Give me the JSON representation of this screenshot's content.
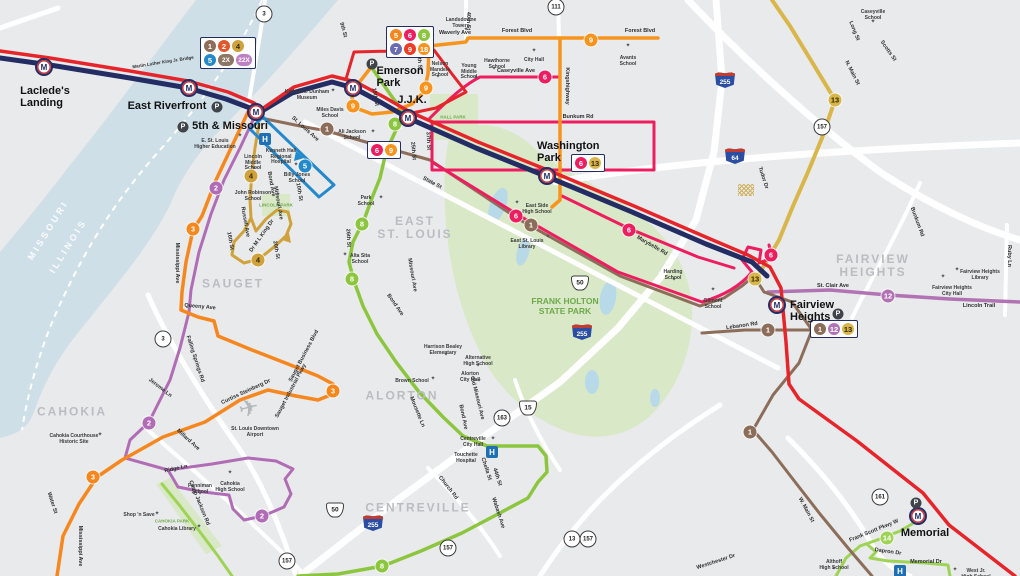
{
  "map": {
    "width": 1020,
    "height": 576,
    "bg": "#e9eaec"
  },
  "colors": {
    "metrolink_navy": "#232d63",
    "metrolink_red": "#e6252b",
    "river": "#cfdfe8",
    "road": "#ffffff",
    "park": "#d9e8c6",
    "pond": "#b8d9e8",
    "area_label": "#b9bdc2",
    "park_label": "#6ea94c",
    "routes": {
      "1": "#8c6d5a",
      "2": "#b06db5",
      "3": "#f6871f",
      "4": "#cfa23c",
      "5": "#2389cb",
      "6": "#ee1d60",
      "7": "#6b6cb0",
      "8": "#8cc63f",
      "9": "#f7941d",
      "12": "#b273b5",
      "13": "#d9b64a",
      "14": "#9fd356",
      "18": "#f6921e",
      "2X": "#8d7663",
      "22X": "#c07fc4"
    }
  },
  "areas": [
    {
      "t": "SAUGET",
      "x": 233,
      "y": 284
    },
    {
      "t": "CAHOKIA",
      "x": 72,
      "y": 412
    },
    {
      "t": "EAST\nST. LOUIS",
      "x": 415,
      "y": 228
    },
    {
      "t": "ALORTON",
      "x": 402,
      "y": 396
    },
    {
      "t": "CENTREVILLE",
      "x": 418,
      "y": 508
    },
    {
      "t": "FAIRVIEW\nHEIGHTS",
      "x": 873,
      "y": 266
    }
  ],
  "river_labels": [
    {
      "t": "MISSOURI",
      "x": 48,
      "y": 230,
      "r": -58
    },
    {
      "t": "ILLINOIS",
      "x": 68,
      "y": 246,
      "r": -58
    }
  ],
  "park_labels": [
    {
      "t": "FRANK HOLTON\nSTATE PARK",
      "x": 565,
      "y": 307,
      "s": 8.5
    },
    {
      "t": "HALL PARK",
      "x": 453,
      "y": 117,
      "s": 4.5
    },
    {
      "t": "LINCOLN PARK",
      "x": 276,
      "y": 205,
      "s": 4.5
    },
    {
      "t": "CAHOKIA PARK",
      "x": 172,
      "y": 521,
      "s": 4.5
    }
  ],
  "stations": [
    {
      "name": "lacledes-landing",
      "t": "Laclede's\nLanding",
      "mx": 44,
      "my": 67,
      "lx": 45,
      "ly": 86,
      "align": "c"
    },
    {
      "name": "east-riverfront",
      "t": "East Riverfront",
      "mx": 189,
      "my": 88,
      "lx": 167,
      "ly": 101,
      "align": "c"
    },
    {
      "name": "5th-missouri",
      "t": "5th & Missouri",
      "mx": 256,
      "my": 112,
      "lx": 230,
      "ly": 121,
      "align": "c"
    },
    {
      "name": "emerson-park",
      "t": "Emerson\nPark",
      "mx": 353,
      "my": 88,
      "lx": 400,
      "ly": 66,
      "align": "c"
    },
    {
      "name": "jjk",
      "t": "J.J.K.",
      "mx": 408,
      "my": 118,
      "lx": 412,
      "ly": 95,
      "align": "c"
    },
    {
      "name": "washington-park",
      "t": "Washington\nPark",
      "mx": 547,
      "my": 176,
      "lx": 537,
      "ly": 141,
      "align": "l"
    },
    {
      "name": "fairview-heights",
      "t": "Fairview\nHeights",
      "mx": 777,
      "my": 305,
      "lx": 790,
      "ly": 300,
      "align": "l"
    },
    {
      "name": "memorial",
      "t": "Memorial",
      "mx": 918,
      "my": 516,
      "lx": 925,
      "ly": 528,
      "align": "c"
    }
  ],
  "p_markers": [
    [
      217,
      107
    ],
    [
      183,
      127
    ],
    [
      372,
      64
    ],
    [
      838,
      314
    ],
    [
      916,
      503
    ]
  ],
  "hospitals": [
    [
      265,
      139
    ],
    [
      492,
      452
    ],
    [
      900,
      571
    ]
  ],
  "badge_boxes": [
    {
      "x": 228,
      "y": 53,
      "rows": [
        [
          {
            "n": "1",
            "c": "#8c6d5a"
          },
          {
            "n": "2",
            "c": "#e2572b"
          },
          {
            "n": "4",
            "c": "#cfa23c",
            "tc": "#332800"
          }
        ],
        [
          {
            "n": "5",
            "c": "#2389cb"
          },
          {
            "n": "2X",
            "c": "#8d7663"
          },
          {
            "n": "22X",
            "c": "#c07fc4"
          }
        ]
      ]
    },
    {
      "x": 410,
      "y": 42,
      "rows": [
        [
          {
            "n": "5",
            "c": "#f6871f"
          },
          {
            "n": "6",
            "c": "#ee1d60"
          },
          {
            "n": "8",
            "c": "#8cc63f"
          }
        ],
        [
          {
            "n": "7",
            "c": "#6b6cb0"
          },
          {
            "n": "9",
            "c": "#ee3b24"
          },
          {
            "n": "18",
            "c": "#f6921e"
          }
        ]
      ]
    },
    {
      "x": 384,
      "y": 150,
      "rows": [
        [
          {
            "n": "6",
            "c": "#ee1d60"
          },
          {
            "n": "9",
            "c": "#f7941d"
          }
        ]
      ]
    },
    {
      "x": 588,
      "y": 163,
      "rows": [
        [
          {
            "n": "6",
            "c": "#ee1d60"
          },
          {
            "n": "13",
            "c": "#d9b64a",
            "tc": "#332800"
          }
        ]
      ]
    },
    {
      "x": 834,
      "y": 329,
      "rows": [
        [
          {
            "n": "1",
            "c": "#8c6d5a"
          },
          {
            "n": "12",
            "c": "#b273b5"
          },
          {
            "n": "13",
            "c": "#d9b64a",
            "tc": "#332800"
          }
        ]
      ]
    }
  ],
  "badges": [
    {
      "n": "1",
      "x": 327,
      "y": 129
    },
    {
      "n": "1",
      "x": 531,
      "y": 225
    },
    {
      "n": "1",
      "x": 768,
      "y": 330
    },
    {
      "n": "1",
      "x": 750,
      "y": 432
    },
    {
      "n": "2",
      "x": 216,
      "y": 188
    },
    {
      "n": "2",
      "x": 149,
      "y": 423
    },
    {
      "n": "2",
      "x": 262,
      "y": 516
    },
    {
      "n": "3",
      "x": 193,
      "y": 229
    },
    {
      "n": "3",
      "x": 93,
      "y": 477
    },
    {
      "n": "3",
      "x": 333,
      "y": 391
    },
    {
      "n": "4",
      "x": 251,
      "y": 176,
      "tc": "#332800"
    },
    {
      "n": "4",
      "x": 258,
      "y": 260,
      "tc": "#332800"
    },
    {
      "n": "5",
      "x": 305,
      "y": 166
    },
    {
      "n": "6",
      "x": 545,
      "y": 77
    },
    {
      "n": "6",
      "x": 516,
      "y": 216
    },
    {
      "n": "6",
      "x": 629,
      "y": 230
    },
    {
      "n": "6",
      "x": 771,
      "y": 255
    },
    {
      "n": "8",
      "x": 395,
      "y": 124
    },
    {
      "n": "8",
      "x": 362,
      "y": 224
    },
    {
      "n": "8",
      "x": 352,
      "y": 279
    },
    {
      "n": "8",
      "x": 382,
      "y": 566
    },
    {
      "n": "9",
      "x": 353,
      "y": 106
    },
    {
      "n": "9",
      "x": 426,
      "y": 88
    },
    {
      "n": "9",
      "x": 591,
      "y": 40
    },
    {
      "n": "12",
      "x": 888,
      "y": 296
    },
    {
      "n": "13",
      "x": 835,
      "y": 100,
      "tc": "#332800"
    },
    {
      "n": "13",
      "x": 755,
      "y": 279,
      "tc": "#332800"
    },
    {
      "n": "14",
      "x": 887,
      "y": 538
    }
  ],
  "shields": [
    {
      "k": "c",
      "t": "3",
      "x": 264,
      "y": 14
    },
    {
      "k": "c",
      "t": "111",
      "x": 556,
      "y": 7
    },
    {
      "k": "c",
      "t": "3",
      "x": 163,
      "y": 339
    },
    {
      "k": "c",
      "t": "157",
      "x": 822,
      "y": 127
    },
    {
      "k": "c",
      "t": "157",
      "x": 448,
      "y": 548
    },
    {
      "k": "c",
      "t": "13",
      "x": 572,
      "y": 539
    },
    {
      "k": "c",
      "t": "157",
      "x": 588,
      "y": 539
    },
    {
      "k": "c",
      "t": "157",
      "x": 287,
      "y": 561
    },
    {
      "k": "c",
      "t": "163",
      "x": 502,
      "y": 418
    },
    {
      "k": "c",
      "t": "161",
      "x": 880,
      "y": 497
    },
    {
      "k": "u",
      "t": "50",
      "x": 580,
      "y": 283
    },
    {
      "k": "u",
      "t": "50",
      "x": 335,
      "y": 510
    },
    {
      "k": "u",
      "t": "15",
      "x": 528,
      "y": 408
    },
    {
      "k": "i",
      "t": "255",
      "x": 725,
      "y": 80
    },
    {
      "k": "i",
      "t": "64",
      "x": 735,
      "y": 156
    },
    {
      "k": "i",
      "t": "255",
      "x": 582,
      "y": 332
    },
    {
      "k": "i",
      "t": "255",
      "x": 373,
      "y": 523
    }
  ],
  "streets": [
    {
      "t": "Martin Luther King Jr. Bridge",
      "x": 163,
      "y": 62,
      "r": -9,
      "s": 4.5
    },
    {
      "t": "Waverly Ave",
      "x": 455,
      "y": 33,
      "r": 0
    },
    {
      "t": "Forest Blvd",
      "x": 517,
      "y": 31,
      "r": 0
    },
    {
      "t": "Forest Blvd",
      "x": 640,
      "y": 31,
      "r": 0
    },
    {
      "t": "40th St",
      "x": 468,
      "y": 21,
      "r": 90
    },
    {
      "t": "9th St",
      "x": 343,
      "y": 30,
      "r": 75
    },
    {
      "t": "25th St",
      "x": 419,
      "y": 61,
      "r": 85
    },
    {
      "t": "25th St",
      "x": 413,
      "y": 151,
      "r": 85
    },
    {
      "t": "15th St",
      "x": 375,
      "y": 97,
      "r": 80
    },
    {
      "t": "Kingshighway",
      "x": 567,
      "y": 86,
      "r": 90
    },
    {
      "t": "Caseyville Ave",
      "x": 516,
      "y": 71,
      "r": 0
    },
    {
      "t": "Bunkum Rd",
      "x": 578,
      "y": 117,
      "r": 0
    },
    {
      "t": "37th St",
      "x": 428,
      "y": 141,
      "r": 87
    },
    {
      "t": "State St",
      "x": 432,
      "y": 183,
      "r": 28
    },
    {
      "t": "St. Louis Ave",
      "x": 305,
      "y": 129,
      "r": 42
    },
    {
      "t": "Missouri Ave",
      "x": 278,
      "y": 203,
      "r": 80
    },
    {
      "t": "Missouri Ave",
      "x": 412,
      "y": 275,
      "r": 80
    },
    {
      "t": "Bond Ave",
      "x": 271,
      "y": 184,
      "r": 80
    },
    {
      "t": "10th St",
      "x": 299,
      "y": 192,
      "r": 80
    },
    {
      "t": "26th St",
      "x": 348,
      "y": 238,
      "r": 87
    },
    {
      "t": "Bond Ave",
      "x": 395,
      "y": 305,
      "r": 55
    },
    {
      "t": "Mississippi Ave",
      "x": 177,
      "y": 263,
      "r": 90
    },
    {
      "t": "Queeny Ave",
      "x": 200,
      "y": 307,
      "r": 5
    },
    {
      "t": "Falling Springs Rd",
      "x": 195,
      "y": 359,
      "r": 72
    },
    {
      "t": "Russell Ave",
      "x": 245,
      "y": 222,
      "r": 80
    },
    {
      "t": "16th St",
      "x": 230,
      "y": 241,
      "r": 80
    },
    {
      "t": "20th St",
      "x": 276,
      "y": 250,
      "r": 80
    },
    {
      "t": "Dr M L King Dr",
      "x": 262,
      "y": 236,
      "r": -55
    },
    {
      "t": "Sauget Business Blvd",
      "x": 304,
      "y": 356,
      "r": -62
    },
    {
      "t": "Sauget Industrial Pkwy",
      "x": 291,
      "y": 391,
      "r": -62
    },
    {
      "t": "Curtiss Steinberg Dr",
      "x": 246,
      "y": 392,
      "r": -25
    },
    {
      "t": "Jerome Ln",
      "x": 160,
      "y": 388,
      "r": 38
    },
    {
      "t": "Millard Ave",
      "x": 188,
      "y": 440,
      "r": 42
    },
    {
      "t": "Ridge Ln",
      "x": 176,
      "y": 469,
      "r": -12
    },
    {
      "t": "Camp Jackson Rd",
      "x": 199,
      "y": 503,
      "r": 68
    },
    {
      "t": "Water St",
      "x": 52,
      "y": 503,
      "r": 72
    },
    {
      "t": "Mississippi Ave",
      "x": 80,
      "y": 546,
      "r": 90
    },
    {
      "t": "Mousette Ln",
      "x": 417,
      "y": 412,
      "r": 68
    },
    {
      "t": "Old Missouri Ave",
      "x": 477,
      "y": 398,
      "r": 76
    },
    {
      "t": "Bond Ave",
      "x": 463,
      "y": 417,
      "r": 78
    },
    {
      "t": "Church Rd",
      "x": 448,
      "y": 488,
      "r": 52
    },
    {
      "t": "Chella St",
      "x": 486,
      "y": 469,
      "r": 72
    },
    {
      "t": "44th St",
      "x": 497,
      "y": 477,
      "r": 72
    },
    {
      "t": "Wabash Ave",
      "x": 498,
      "y": 513,
      "r": 72
    },
    {
      "t": "Westchester Dr",
      "x": 716,
      "y": 562,
      "r": -18
    },
    {
      "t": "W. Main St",
      "x": 806,
      "y": 510,
      "r": 62
    },
    {
      "t": "Frank Scott Pkwy W",
      "x": 874,
      "y": 531,
      "r": -22
    },
    {
      "t": "Dapron Dr",
      "x": 888,
      "y": 552,
      "r": 8
    },
    {
      "t": "Memorial Dr",
      "x": 926,
      "y": 562,
      "r": 0
    },
    {
      "t": "Marybelle Rd",
      "x": 652,
      "y": 246,
      "r": 30
    },
    {
      "t": "Tudor Dr",
      "x": 763,
      "y": 178,
      "r": 72
    },
    {
      "t": "N. Main St",
      "x": 852,
      "y": 73,
      "r": 63
    },
    {
      "t": "Long St",
      "x": 854,
      "y": 31,
      "r": 68
    },
    {
      "t": "Scotts St",
      "x": 888,
      "y": 51,
      "r": 55
    },
    {
      "t": "St. Clair Ave",
      "x": 833,
      "y": 286,
      "r": 0
    },
    {
      "t": "Lincoln Trail",
      "x": 979,
      "y": 306,
      "r": 0
    },
    {
      "t": "Bunkum Rd",
      "x": 917,
      "y": 222,
      "r": 70
    },
    {
      "t": "Ruby Ln",
      "x": 1009,
      "y": 256,
      "r": 90
    },
    {
      "t": "Lebanon Rd",
      "x": 742,
      "y": 326,
      "r": -8
    }
  ],
  "pois": [
    {
      "t": "Katherine Dunham\nMuseum",
      "x": 307,
      "y": 90,
      "d": [
        26,
        1
      ]
    },
    {
      "t": "Miles Davis\nSchool",
      "x": 330,
      "y": 108,
      "d": [
        19,
        -1
      ]
    },
    {
      "t": "Ali Jackson\nSchool",
      "x": 352,
      "y": 130,
      "d": [
        21,
        2
      ]
    },
    {
      "t": "E. St. Louis\nHigher Education",
      "x": 215,
      "y": 139,
      "d": [
        25,
        -3
      ]
    },
    {
      "t": "Lincoln\nMiddle\nSchool",
      "x": 253,
      "y": 155,
      "d": [
        1,
        14
      ]
    },
    {
      "t": "Kenneth Hall\nRegional\nHospital",
      "x": 281,
      "y": 149,
      "d": null
    },
    {
      "t": "Billy Jones\nSchool",
      "x": 297,
      "y": 173,
      "d": [
        -1,
        -8
      ]
    },
    {
      "t": "John Robinson\nSchool",
      "x": 253,
      "y": 191,
      "d": [
        25,
        4
      ]
    },
    {
      "t": "Nelson\nMandela\nSchool",
      "x": 440,
      "y": 62,
      "d": [
        -2,
        15
      ]
    },
    {
      "t": "Landsdowne\nTowers",
      "x": 461,
      "y": 18,
      "d": [
        5,
        12
      ]
    },
    {
      "t": "Young\nMiddle\nSchool",
      "x": 469,
      "y": 64,
      "d": [
        7,
        14
      ]
    },
    {
      "t": "Hawthorne\nSchool",
      "x": 497,
      "y": 59,
      "d": [
        -3,
        10
      ]
    },
    {
      "t": "City Hall",
      "x": 534,
      "y": 58,
      "d": [
        0,
        -7
      ]
    },
    {
      "t": "Avants\nSchool",
      "x": 628,
      "y": 56,
      "d": [
        0,
        -10
      ]
    },
    {
      "t": "Caseyville\nSchool",
      "x": 873,
      "y": 10,
      "d": [
        0,
        12
      ]
    },
    {
      "t": "East Side\nHigh School",
      "x": 537,
      "y": 204,
      "d": [
        -20,
        -1
      ]
    },
    {
      "t": "East St. Louis\nLibrary",
      "x": 527,
      "y": 239,
      "d": [
        21,
        -2
      ]
    },
    {
      "t": "Park\nSchool",
      "x": 366,
      "y": 196,
      "d": [
        15,
        2
      ]
    },
    {
      "t": "Alta Sita\nSchool",
      "x": 360,
      "y": 254,
      "d": [
        -15,
        1
      ]
    },
    {
      "t": "Harding\nSchool",
      "x": 673,
      "y": 270,
      "d": [
        1,
        10
      ]
    },
    {
      "t": "Gilmont\nSchool",
      "x": 713,
      "y": 299,
      "d": [
        0,
        -9
      ]
    },
    {
      "t": "Fairview Heights\nLibrary",
      "x": 980,
      "y": 270,
      "d": [
        -23,
        0
      ]
    },
    {
      "t": "Fairview Heights\nCity Hall",
      "x": 952,
      "y": 286,
      "d": [
        -9,
        -9
      ]
    },
    {
      "t": "Cahokia Courthouse\nHistoric Site",
      "x": 74,
      "y": 434,
      "d": [
        26,
        1
      ]
    },
    {
      "t": "Shop 'n Save",
      "x": 139,
      "y": 513,
      "d": [
        18,
        1
      ]
    },
    {
      "t": "Penniman\nSchool",
      "x": 200,
      "y": 484,
      "d": [
        0,
        10
      ]
    },
    {
      "t": "Cahokia\nHigh School",
      "x": 230,
      "y": 482,
      "d": [
        0,
        -9
      ]
    },
    {
      "t": "Cahokia Library",
      "x": 177,
      "y": 527,
      "d": [
        22,
        0
      ]
    },
    {
      "t": "Centreville\nCity Hall",
      "x": 473,
      "y": 437,
      "d": [
        20,
        2
      ]
    },
    {
      "t": "Touchette\nHospital",
      "x": 466,
      "y": 453,
      "d": null
    },
    {
      "t": "Althoff\nHigh School",
      "x": 834,
      "y": 560,
      "d": [
        0,
        9
      ]
    },
    {
      "t": "West Jr.\nHigh School",
      "x": 976,
      "y": 569,
      "d": [
        -21,
        1
      ]
    },
    {
      "t": "Harrison Bealey\nElementary",
      "x": 443,
      "y": 345,
      "d": [
        3,
        10
      ]
    },
    {
      "t": "Alternative\nHigh School",
      "x": 478,
      "y": 356,
      "d": [
        0,
        10
      ]
    },
    {
      "t": "Alorton\nCity Hall",
      "x": 470,
      "y": 372,
      "d": [
        9,
        9
      ]
    },
    {
      "t": "Brown School",
      "x": 412,
      "y": 379,
      "d": [
        21,
        0
      ]
    }
  ],
  "airport": {
    "t": "St. Louis Downtown\nAirport",
    "x": 255,
    "y": 427,
    "plane": [
      249,
      409
    ]
  },
  "hatch": [
    746,
    190
  ]
}
